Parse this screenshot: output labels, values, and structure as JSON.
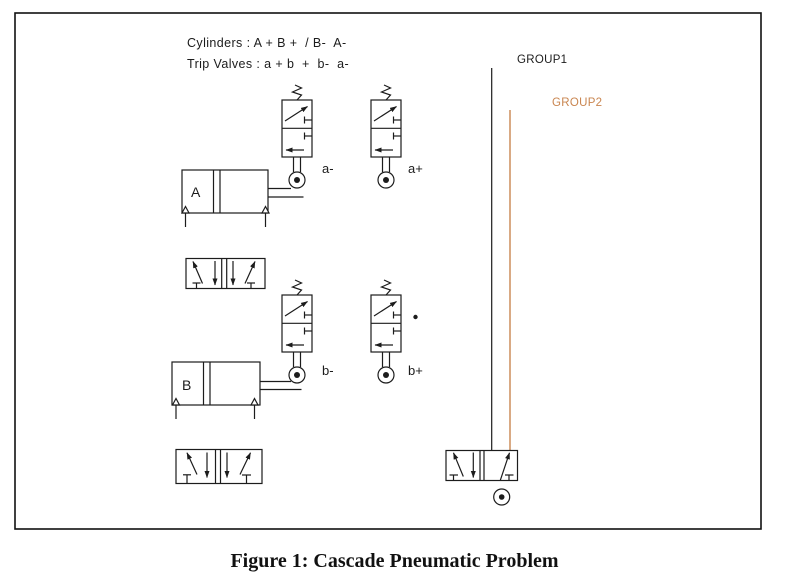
{
  "header": {
    "line1": "Cylinders : A + B +  / B-  A-",
    "line2": "Trip Valves : a + b  +  b-  a-"
  },
  "groups": {
    "group1": {
      "label": "GROUP1",
      "color": "#1c1c1c"
    },
    "group2": {
      "label": "GROUP2",
      "color": "#c9854f"
    }
  },
  "cylinders": {
    "a": {
      "label": "A"
    },
    "b": {
      "label": "B"
    }
  },
  "trip_valve_labels": {
    "a_minus": "a-",
    "a_plus": "a+",
    "b_minus": "b-",
    "b_plus": "b+"
  },
  "caption": "Figure 1: Cascade Pneumatic Problem"
}
